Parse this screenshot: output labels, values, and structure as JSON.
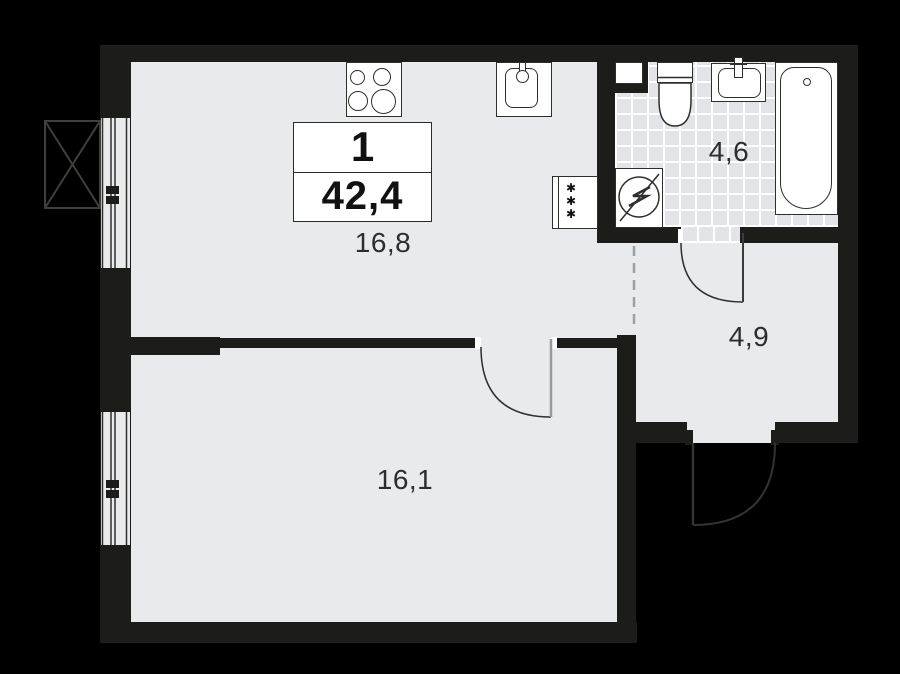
{
  "plan": {
    "title": "1-room apartment floor plan",
    "unit_box": {
      "rooms": "1",
      "area": "42,4"
    },
    "rooms": {
      "kitchen_living": {
        "area": "16,8"
      },
      "bedroom": {
        "area": "16,1"
      },
      "bathroom": {
        "area": "4,6"
      },
      "hallway": {
        "area": "4,9"
      }
    },
    "icons": {
      "freezer_mark": "✱"
    },
    "colors": {
      "bg": "#000000",
      "floor": "#e8eaec",
      "tile": "#e2e4e7",
      "wall": "#1c1c1a",
      "line": "#2e2e2c",
      "text": "#2d2d2d",
      "white": "#ffffff",
      "dash": "#9aa1a6",
      "dim": "#3f3f3b"
    }
  }
}
